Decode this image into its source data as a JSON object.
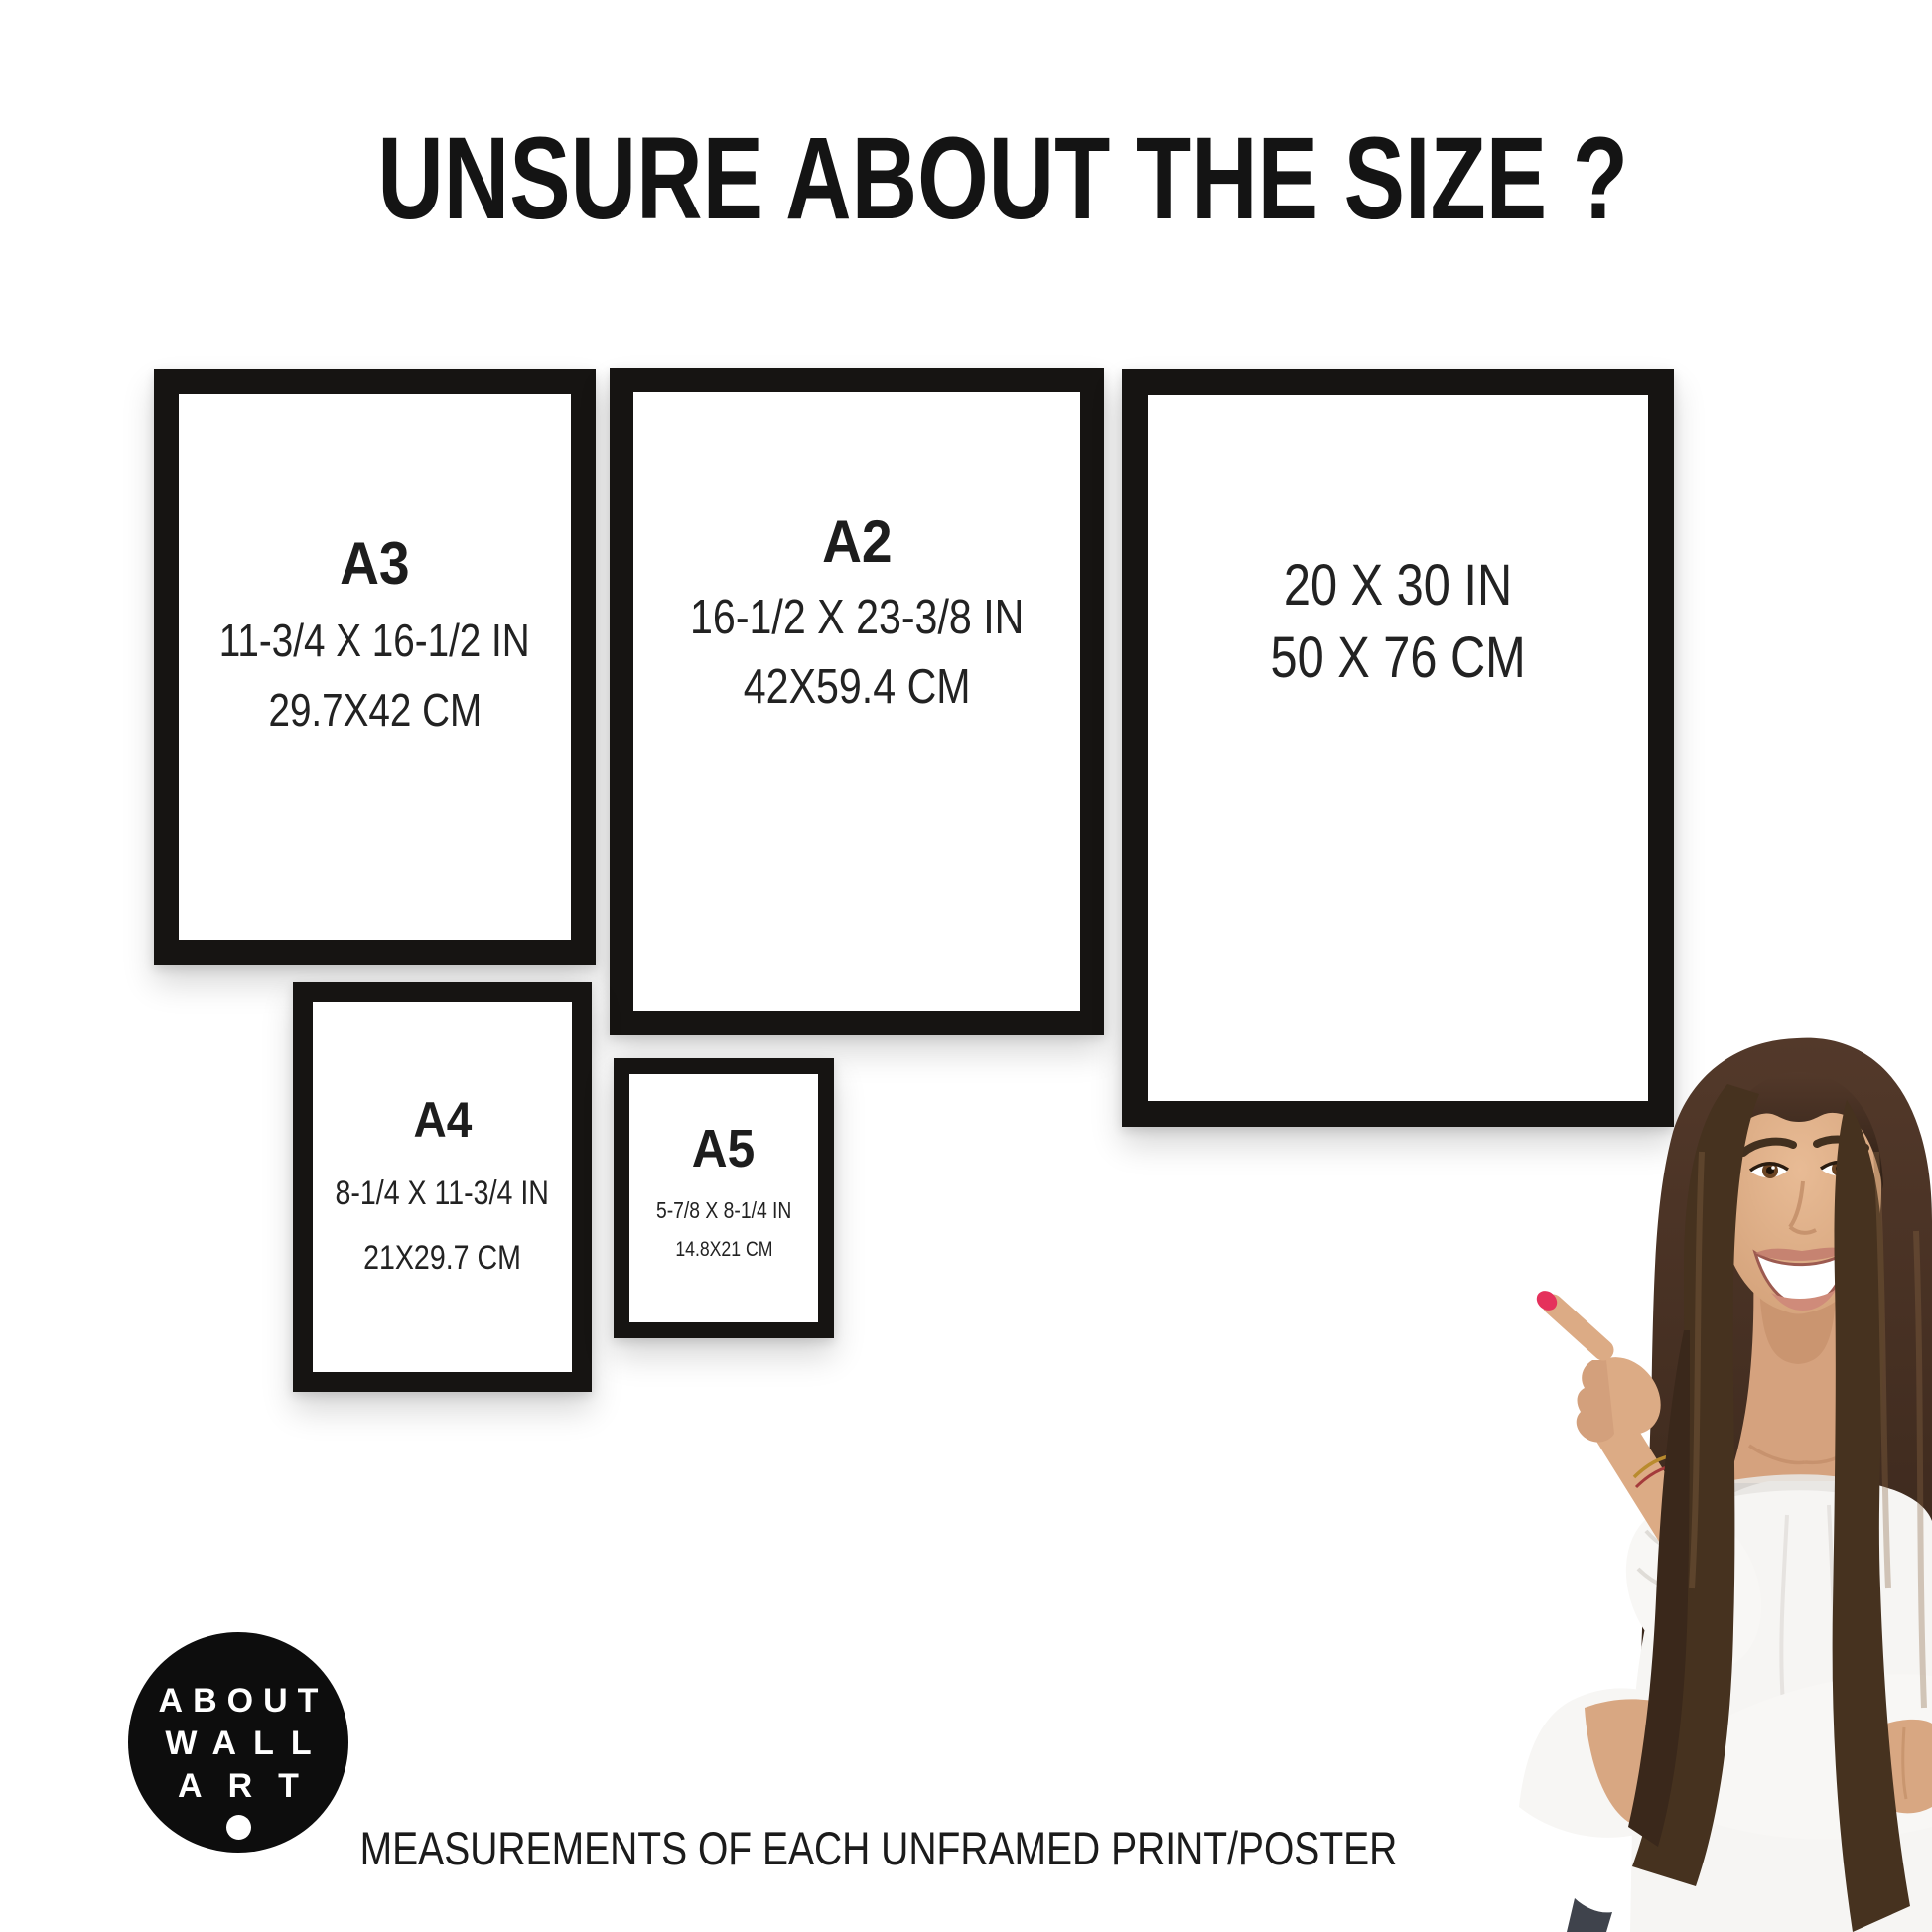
{
  "page": {
    "title": "UNSURE ABOUT THE SIZE ?",
    "caption": "MEASUREMENTS OF EACH UNFRAMED PRINT/POSTER"
  },
  "logo": {
    "line1": "ABOUT",
    "line2": "WALL",
    "line3": "ART"
  },
  "frames": {
    "a3": {
      "label": "A3",
      "inches": "11-3/4 X 16-1/2 IN",
      "cm": "29.7X42 CM"
    },
    "a2": {
      "label": "A2",
      "inches": "16-1/2 X 23-3/8 IN",
      "cm": "42X59.4 CM"
    },
    "s20x30": {
      "inches": "20 X 30 IN",
      "cm": "50 X 76 CM"
    },
    "a4": {
      "label": "A4",
      "inches": "8-1/4 X 11-3/4 IN",
      "cm": "21X29.7 CM"
    },
    "a5": {
      "label": "A5",
      "inches": "5-7/8 X 8-1/4 IN",
      "cm": "14.8X21 CM"
    }
  },
  "colors": {
    "background": "#ffffff",
    "frame_border": "#161412",
    "text": "#1c1c1c",
    "logo_bg": "#0d0d0d",
    "logo_text": "#ffffff",
    "nail_polish": "#e5315c",
    "hair": "#46321f",
    "skin": "#d8a782",
    "blouse": "#f6f5f3"
  },
  "illustration": {
    "alt": "smiling woman with long brown hair pointing at the frames"
  }
}
